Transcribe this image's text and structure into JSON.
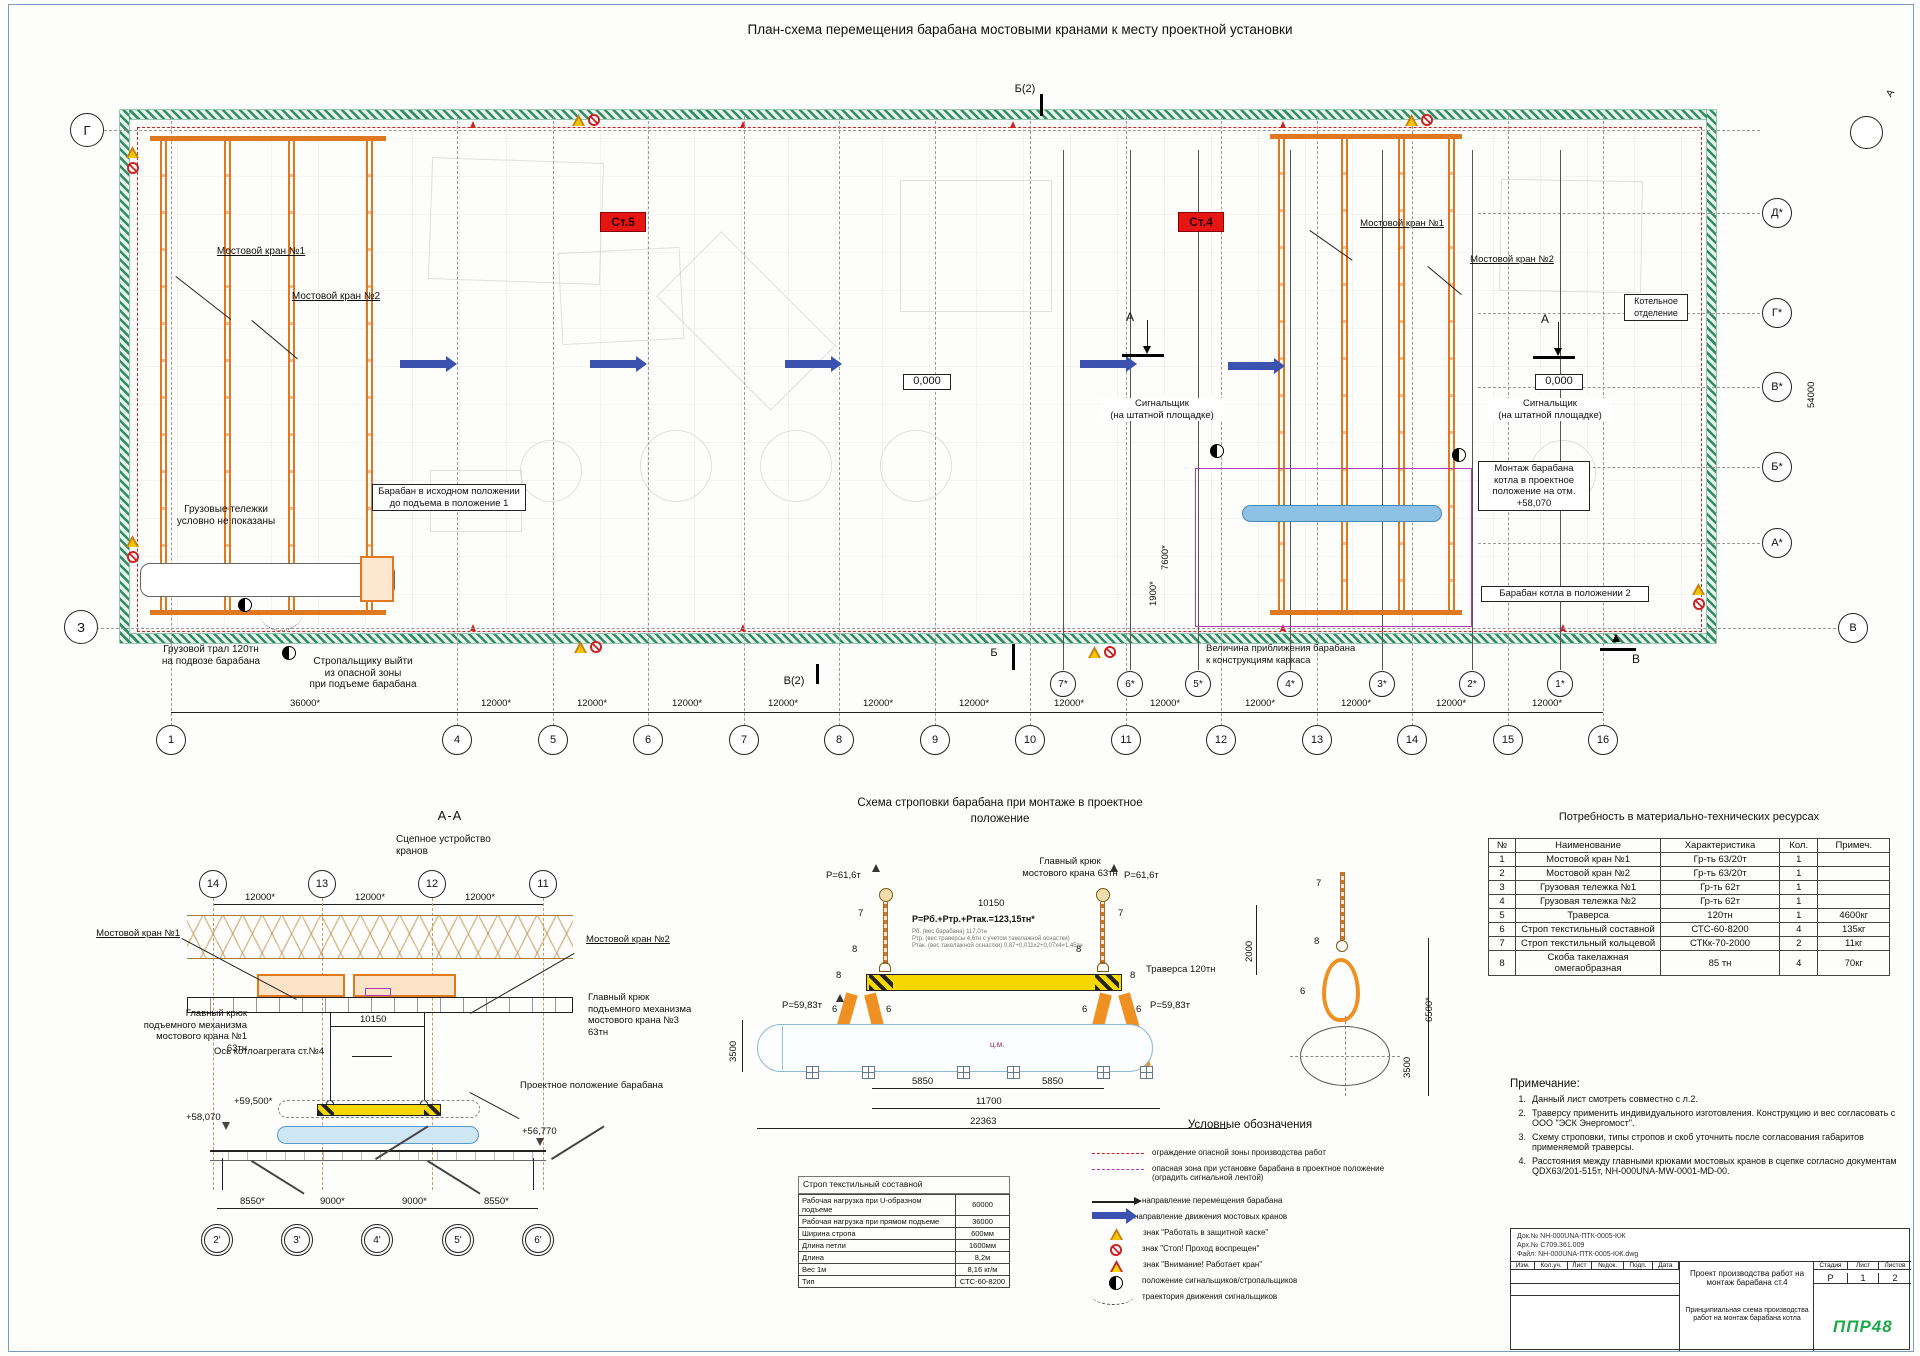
{
  "colors": {
    "accent_orange": "#e07820",
    "danger_red": "#cc2222",
    "zone_magenta": "#b238b2",
    "crane_blue": "#3c52b0",
    "drum_blue": "#8fc0e0",
    "traverse_yellow": "#f6d800",
    "hatch_green": "#2f8f62",
    "logo_green": "#1faa4a"
  },
  "sheet": {
    "title": "План-схема перемещения барабана мостовыми кранами к месту проектной установки"
  },
  "plan": {
    "crane1": "Мостовой кран №1",
    "crane2": "Мостовой кран №2",
    "trolleys_note": "Грузовые тележки\nусловно не показаны",
    "drum_initial": "Барабан в исходном положении\nдо подъема в положение 1",
    "trawl": "Грузовой трал 120тн\nна подвозе барабана",
    "rigger_exit": "Стропальщику выйти\nиз опасной зоны\nпри подъеме барабана",
    "signaller": "Сигнальщик\n(на штатной площадке)",
    "mount_drum": "Монтаж барабана\nкотла в проектное\nположение на отм.\n+58,070",
    "drum_pos2": "Барабан котла в положении 2",
    "approach": "Величина приближения барабана\nк конструкциям каркаса",
    "boiler_room": "Котельное\nотделение",
    "st5": "Ст.5",
    "st4": "Ст.4",
    "elev0": "0,000",
    "sec_b2": "Б(2)",
    "sec_b": "Б",
    "sec_v2": "В(2)",
    "sec_v": "В",
    "sec_a": "А",
    "view_a": "А",
    "dims": {
      "bay36": "36000*",
      "bay12": "12000*",
      "h54": "54000",
      "v7600": "7600*",
      "v1900": "1900*"
    },
    "grid": {
      "row_tl": "Г",
      "row_bl": "З",
      "right": [
        "Д*",
        "Г*",
        "В*",
        "Б*",
        "А*"
      ],
      "right_bottom": "В",
      "cols": [
        "1",
        "4",
        "5",
        "6",
        "7",
        "8",
        "9",
        "10",
        "11",
        "12",
        "13",
        "14",
        "15",
        "16"
      ],
      "starred": [
        "7*",
        "6*",
        "5*",
        "4*",
        "3*",
        "2*",
        "1*"
      ]
    }
  },
  "section_aa": {
    "title": "А-А",
    "coupling": "Сцепное устройство\nкранов",
    "hook1": "Главный крюк\nподъемного механизма\nмостового крана №1\n63тн",
    "hook3": "Главный крюк\nподъемного механизма\nмостового крана №3\n63тн",
    "boiler_axis": "Ось котлоагрегата ст.№4",
    "project_pos": "Проектное положение барабана",
    "dim_10150": "10150",
    "elev1": "+59,500*",
    "elev2": "+58,070",
    "elev3": "+56,770",
    "dims": [
      "8550*",
      "9000*",
      "9000*",
      "8550*"
    ],
    "cols": [
      "14",
      "13",
      "12",
      "11"
    ],
    "cols_bottom": [
      "2'",
      "3'",
      "4'",
      "5'",
      "6'"
    ]
  },
  "rigging": {
    "title_line1": "Схема строповки барабана при монтаже в проектное",
    "title_line2": "положение",
    "main_hook": "Главный крюк\nмостового крана 63тн",
    "p_hook": "P=61,6т",
    "dim_hooks": "10150",
    "formula": "P=Pб.+Pтр.+Pтак.=123,15тн*",
    "formula_notes": [
      "Pб. (вес барабана) 117,0тн",
      "Pтр. (вес траверсы 4,6тн с учетом такелажной оснастки)",
      "Pтак. (вес такелажной оснастки) 0,87+0,011х2+0,07х4=1,45тн"
    ],
    "p_traverse": "P=59,83т",
    "traverse_label": "Траверса 120тн",
    "item6": "6",
    "item7": "7",
    "item8": "8",
    "d5850": "5850",
    "d11700": "11700",
    "d22363": "22363",
    "v3500": "3500",
    "v6500": "6500*",
    "v2000": "2000",
    "cm": "ц.м."
  },
  "legend": {
    "title": "Условные обозначения",
    "items": [
      "ограждение опасной зоны производства работ",
      "опасная зона при установке барабана в проектное положение (оградить сигнальной лентой)",
      "направление перемещения барабана",
      "направление движения мостовых кранов",
      "знак \"Работать в защитной каске\"",
      "знак \"Стоп! Проход воспрещен\"",
      "знак \"Внимание! Работает кран\"",
      "положение сигнальщиков/стропальщиков",
      "траектория движения сигнальщиков"
    ]
  },
  "sling_table": {
    "caption": "Строп текстильный составной",
    "rows": [
      [
        "Рабочая нагрузка при U-образном подъеме",
        "60000"
      ],
      [
        "Рабочая нагрузка при прямом подъеме",
        "36000"
      ],
      [
        "Ширина стропа",
        "600мм"
      ],
      [
        "Длина петли",
        "1600мм"
      ],
      [
        "Длина",
        "8,2м"
      ],
      [
        "Вес 1м",
        "8,16 кг/м"
      ],
      [
        "Тип",
        "СТС-60-8200"
      ]
    ]
  },
  "resources": {
    "title": "Потребность в материально-технических ресурсах",
    "headers": [
      "№",
      "Наименование",
      "Характеристика",
      "Кол.",
      "Примеч."
    ],
    "rows": [
      [
        "1",
        "Мостовой кран №1",
        "Гр-ть 63/20т",
        "1",
        ""
      ],
      [
        "2",
        "Мостовой кран №2",
        "Гр-ть 63/20т",
        "1",
        ""
      ],
      [
        "3",
        "Грузовая тележка №1",
        "Гр-ть 62т",
        "1",
        ""
      ],
      [
        "4",
        "Грузовая тележка №2",
        "Гр-ть 62т",
        "1",
        ""
      ],
      [
        "5",
        "Траверса",
        "120тн",
        "1",
        "4600кг"
      ],
      [
        "6",
        "Строп текстильный составной",
        "СТС-60-8200",
        "4",
        "135кг"
      ],
      [
        "7",
        "Строп текстильный кольцевой",
        "СТКк-70-2000",
        "2",
        "11кг"
      ],
      [
        "8",
        "Скоба такелажная омегаобразная",
        "85 тн",
        "4",
        "70кг"
      ]
    ]
  },
  "notes": {
    "title": "Примечание:",
    "items": [
      "Данный лист смотреть совместно с л.2.",
      "Траверсу применить индивидуального изготовления. Конструкцию и вес согласовать с ООО \"ЭСК Энергомост\".",
      "Схему строповки, типы стропов и скоб уточнить после согласования габаритов применяемой траверсы.",
      "Расстояния между главными крюками мостовых кранов в сцепке согласно документам QDX63/201-515т, NH-000UNA-MW-0001-MD-00."
    ]
  },
  "title_block": {
    "doc_lines": [
      "Док.№ NH-000UNA-ПТК-0005-КЖ",
      "Арх.№ С709.361.009",
      "Файл: NH-000UNA-ПТК-0005-КЖ.dwg"
    ],
    "rev_headers": [
      "Изм.",
      "Кол.уч.",
      "Лист",
      "№док.",
      "Подп.",
      "Дата"
    ],
    "project_title": "Проект производства работ на монтаж барабана ст.4",
    "stage_headers": [
      "Стадия",
      "Лист",
      "Листов"
    ],
    "stage_values": [
      "Р",
      "1",
      "2"
    ],
    "scheme_title": "Принципиальная схема производства работ на монтаж барабана котла",
    "logo": "ППР48"
  }
}
